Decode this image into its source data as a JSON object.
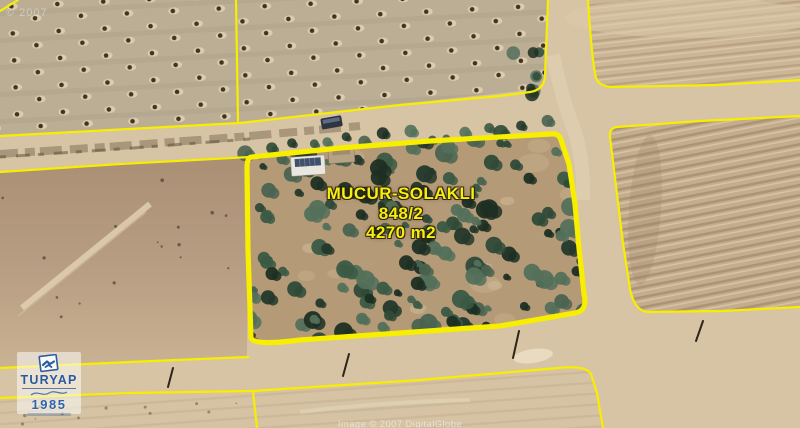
{
  "parcel_label": {
    "name": "MUCUR-SOLAKLI",
    "parcel_no": "848/2",
    "area": "4270 m2"
  },
  "logo": {
    "brand": "TURYAP",
    "year": "1985"
  },
  "watermarks": {
    "top_left": "© 2007",
    "bottom": "Image © 2007 DigitalGlobe"
  },
  "colors": {
    "boundary_yellow": "#f8ee00",
    "label_yellow": "#f2ee16",
    "logo_blue": "#29589f"
  }
}
